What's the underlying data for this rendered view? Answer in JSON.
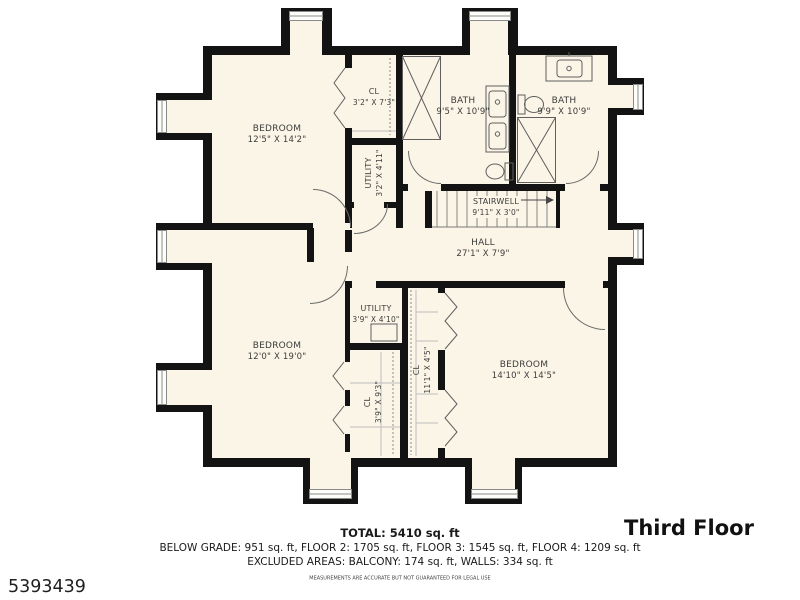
{
  "plan_title": "Third Floor",
  "listing_id": "5393439",
  "rooms": [
    {
      "name": "BEDROOM",
      "dims": "12'5\" X 14'2\""
    },
    {
      "name": "CL",
      "dims": "3'2\" X 7'3\""
    },
    {
      "name": "UTILITY",
      "dims": "3'2\" X 4'11\""
    },
    {
      "name": "BATH",
      "dims": "9'5\" X 10'9\""
    },
    {
      "name": "BATH",
      "dims": "9'9\" X 10'9\""
    },
    {
      "name": "STAIRWELL",
      "dims": "9'11\" X 3'0\""
    },
    {
      "name": "HALL",
      "dims": "27'1\" X 7'9\""
    },
    {
      "name": "BEDROOM",
      "dims": "12'0\" X 19'0\""
    },
    {
      "name": "UTILITY",
      "dims": "3'9\" X 4'10\""
    },
    {
      "name": "CL",
      "dims": "3'9\" X 9'3\""
    },
    {
      "name": "CL",
      "dims": "11'1\" X 4'5\""
    },
    {
      "name": "BEDROOM",
      "dims": "14'10\" X 14'5\""
    }
  ],
  "footer": {
    "total": "TOTAL: 5410 sq. ft",
    "floors": "BELOW GRADE: 951 sq. ft, FLOOR 2: 1705 sq. ft, FLOOR 3: 1545 sq. ft, FLOOR 4: 1209 sq. ft",
    "excluded": "EXCLUDED AREAS: BALCONY: 174 sq. ft, WALLS: 334 sq. ft",
    "disclaimer": "MEASUREMENTS ARE ACCURATE BUT NOT GUARANTEED FOR LEGAL USE"
  },
  "colors": {
    "wall": "#131313",
    "floor": "#FAF5E6",
    "line": "#6b6b6b"
  }
}
